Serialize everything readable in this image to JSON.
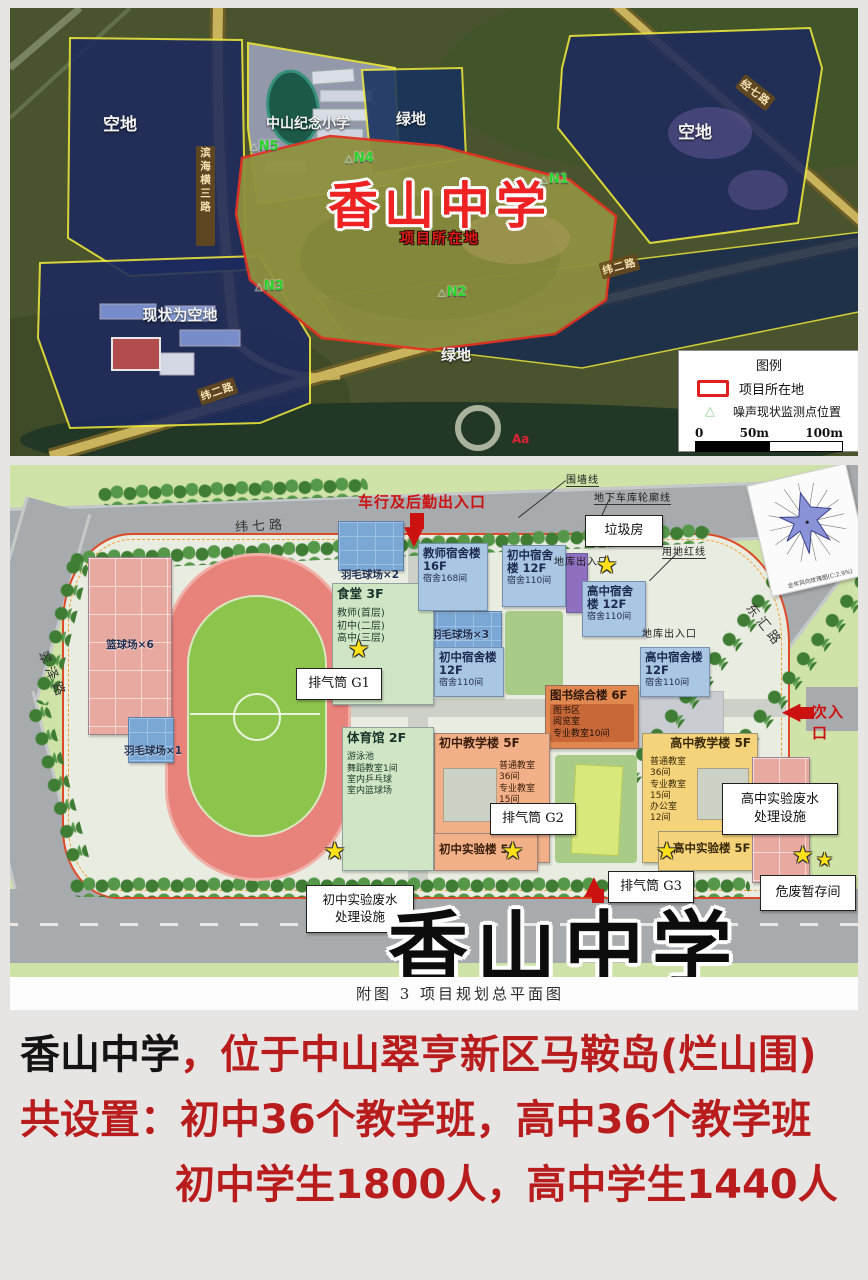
{
  "sat_map": {
    "zone_vacant_left": "空地",
    "zone_school": "中山纪念小学",
    "zone_green_top": "绿地",
    "zone_vacant_right": "空地",
    "zone_vacant_sw": "现状为空地",
    "zone_green_bottom": "绿地",
    "project_title": "香山中学",
    "project_subtitle": "项目所在地",
    "points": [
      {
        "id": "N1"
      },
      {
        "id": "N2"
      },
      {
        "id": "N3"
      },
      {
        "id": "N4"
      },
      {
        "id": "N5"
      }
    ],
    "roads": {
      "binhai": "滨海横三路",
      "jingqi": "经七路",
      "weier_a": "纬二路",
      "weier_b": "纬二路"
    },
    "watermark": "Aa",
    "legend": {
      "title": "图例",
      "item_project": "项目所在地",
      "item_noise": "噪声现状监测点位置",
      "scale_0": "0",
      "scale_50": "50m",
      "scale_100": "100m"
    }
  },
  "site_plan": {
    "roads": {
      "weiqi": "纬七路",
      "cuize": "翠泽路",
      "donghui": "东汇路"
    },
    "entrances": {
      "vehicle": "车行及后勤出入口",
      "secondary": "次入口"
    },
    "lines": {
      "wall": "围墙线",
      "garage_outline": "地下车库轮廓线",
      "red_line": "用地红线",
      "garage_exit_a": "地库出入口",
      "garage_exit_b": "地库出入口"
    },
    "callouts": {
      "garbage": "垃圾房",
      "g1": "排气筒 G1",
      "g2": "排气筒 G2",
      "g3": "排气筒 G3",
      "junior_waste": "初中实验废水\n处理设施",
      "senior_waste": "高中实验废水\n处理设施",
      "hazard": "危废暂存间"
    },
    "sports": {
      "basketball": "篮球场×6",
      "badminton1": "羽毛球场×1",
      "badminton2": "羽毛球场×2",
      "badminton3": "羽毛球场×3"
    },
    "buildings": {
      "teacher_dorm": {
        "name": "教师宿舍楼",
        "floors": "16F",
        "detail": "宿舍168间"
      },
      "junior_dorm1": {
        "name": "初中宿舍楼",
        "floors": "12F",
        "detail": "宿舍110间"
      },
      "junior_dorm2": {
        "name": "初中宿舍楼",
        "floors": "12F",
        "detail": "宿舍110间"
      },
      "senior_dorm1": {
        "name": "高中宿舍楼",
        "floors": "12F",
        "detail": "宿舍110间"
      },
      "senior_dorm2": {
        "name": "高中宿舍楼",
        "floors": "12F",
        "detail": "宿舍110间"
      },
      "canteen": {
        "name": "食堂",
        "floors": "3F",
        "detail": "教师(首层)\n初中(二层)\n高中(三层)"
      },
      "library": {
        "name": "图书综合楼",
        "floors": "6F",
        "detail": "图书区\n阅览室\n专业教室10间"
      },
      "junior_teach": {
        "name": "初中教学楼",
        "floors": "5F",
        "detail": "普通教室\n36间\n专业教室\n15间\n办公室\n12间"
      },
      "senior_teach": {
        "name": "高中教学楼",
        "floors": "5F",
        "detail": "普通教室\n36间\n专业教室\n15间\n办公室\n12间"
      },
      "gym": {
        "name": "体育馆",
        "floors": "2F",
        "detail": "游泳池\n舞蹈教室1间\n室内乒乓球\n室内篮球场"
      },
      "junior_lab": {
        "name": "初中实验楼",
        "floors": "5F"
      },
      "senior_lab": {
        "name": "高中实验楼",
        "floors": "5F"
      }
    },
    "title": "香山中学",
    "caption": "附图 3 项目规划总平面图",
    "windrose_caption": "全年风向玫瑰图(C:2.9%)"
  },
  "description": {
    "line1_black": "香山中学",
    "line1_red": "，位于中山翠亨新区马鞍岛(烂山围)",
    "line2": "共设置：初中36个教学班，高中36个教学班",
    "line3": "初中学生1800人，高中学生1440人"
  }
}
